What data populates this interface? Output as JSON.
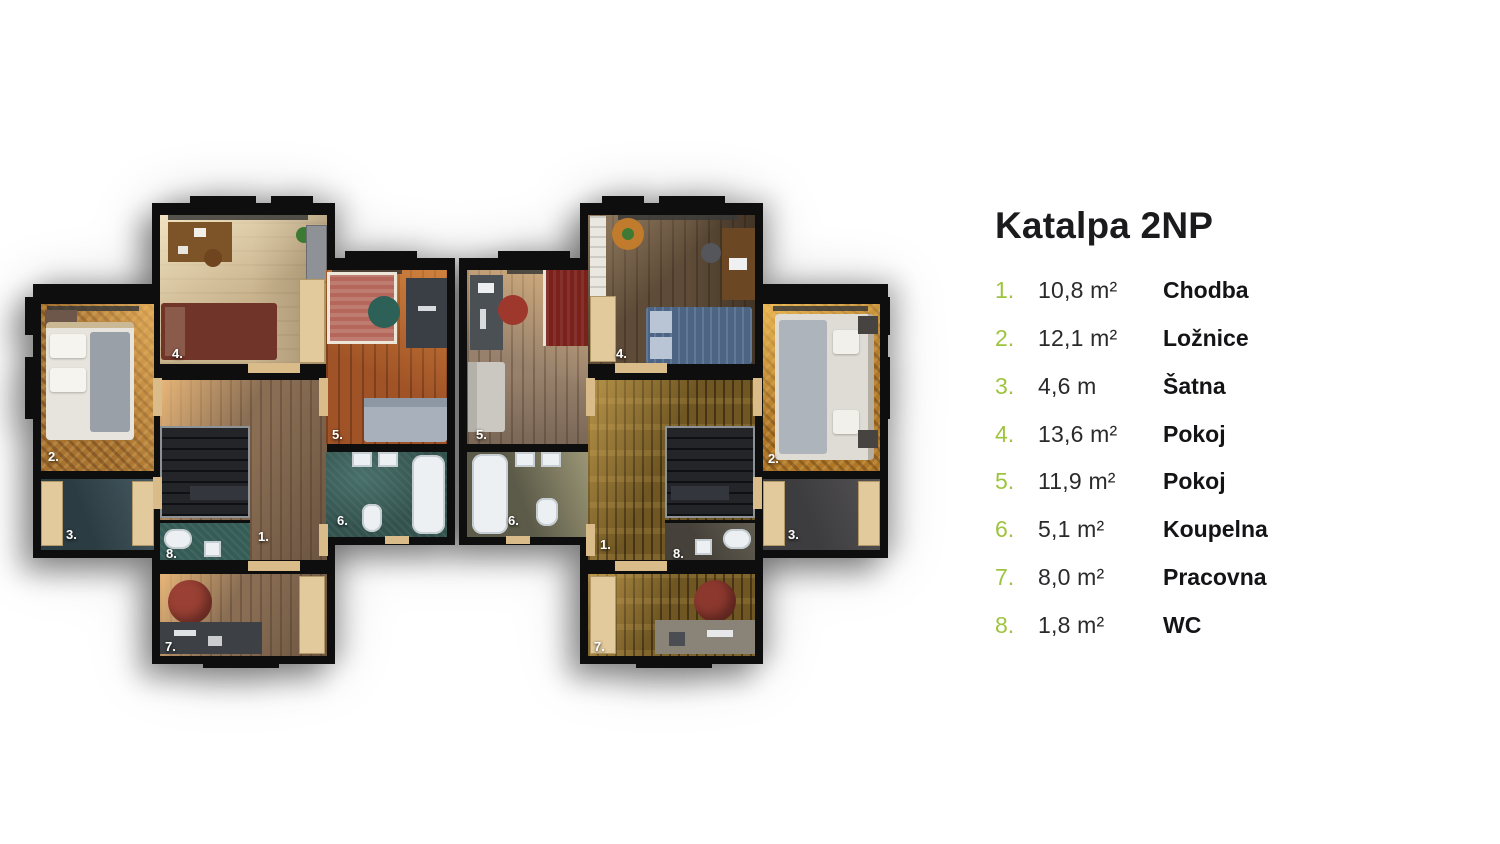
{
  "legend": {
    "title": "Katalpa 2NP",
    "accent_color": "#9ec43f",
    "text_color": "#141416",
    "items": [
      {
        "num": "1.",
        "area": "10,8 m²",
        "name": "Chodba"
      },
      {
        "num": "2.",
        "area": "12,1 m²",
        "name": "Ložnice"
      },
      {
        "num": "3.",
        "area": "4,6 m",
        "name": "Šatna"
      },
      {
        "num": "4.",
        "area": "13,6 m²",
        "name": "Pokoj"
      },
      {
        "num": "5.",
        "area": "11,9 m²",
        "name": "Pokoj"
      },
      {
        "num": "6.",
        "area": "5,1 m²",
        "name": "Koupelna"
      },
      {
        "num": "7.",
        "area": "8,0 m²",
        "name": "Pracovna"
      },
      {
        "num": "8.",
        "area": "1,8 m²",
        "name": "WC"
      }
    ]
  },
  "plan": {
    "wall_color": "#0e0e0f",
    "room_labels": [
      "1.",
      "2.",
      "3.",
      "4.",
      "5.",
      "6.",
      "7.",
      "8."
    ]
  }
}
